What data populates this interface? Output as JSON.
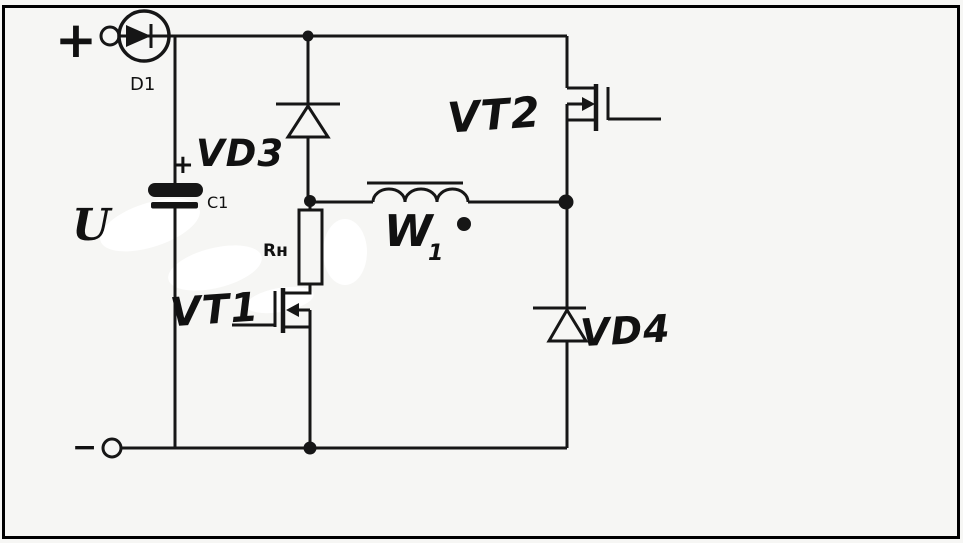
{
  "colors": {
    "ink": "#161616",
    "paper": "#f6f6f4",
    "border": "#000000",
    "whiteout": "#ffffff"
  },
  "terminals": {
    "positive": "+",
    "negative": "−"
  },
  "labels": {
    "diode_d1": "D1",
    "capacitor_c1": "C1",
    "capacitor_polarity": "+",
    "source_voltage": "U",
    "diode_vd3": "VD3",
    "load_resistor": "Rн",
    "transistor_vt1": "VT1",
    "transistor_vt2": "VT2",
    "winding_base": "W",
    "winding_sub": "1",
    "diode_vd4": "VD4"
  }
}
